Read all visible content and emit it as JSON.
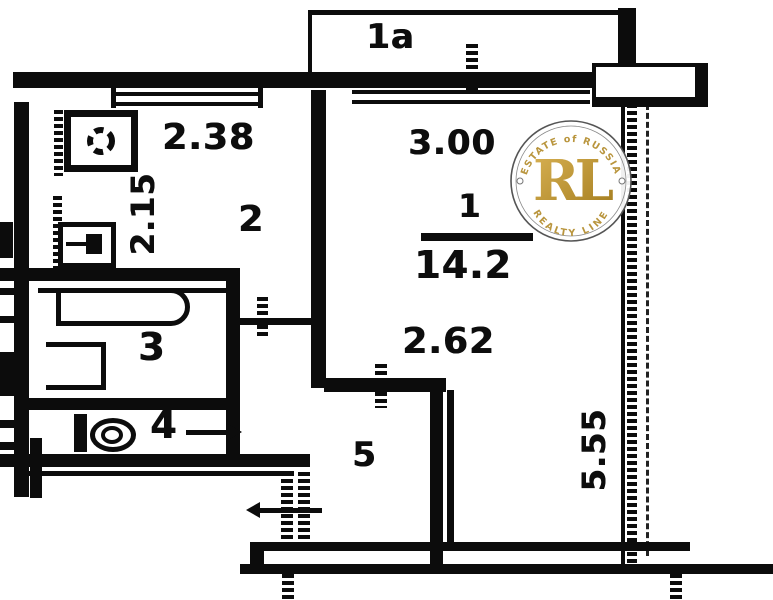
{
  "floorplan": {
    "balcony": {
      "label": "1a"
    },
    "rooms": [
      {
        "number": "1",
        "area": "14.2"
      },
      {
        "number": "2"
      },
      {
        "number": "3"
      },
      {
        "number": "4"
      },
      {
        "number": "5"
      }
    ],
    "dimensions": {
      "kitchen_width": "2.38",
      "kitchen_depth": "2.15",
      "room1_width": "3.00",
      "room1_inner_width": "2.62",
      "room1_depth": "5.55"
    }
  },
  "watermark": {
    "arc_top": "ESTATE of RUSSIA",
    "arc_bottom": "REALTY LINE",
    "monogram": "RL",
    "colors": {
      "gold": "#c59b33",
      "ring": "#555555",
      "arc_text": "#b9953d"
    }
  },
  "colors": {
    "ink": "#0c0c0c",
    "paper": "#ffffff"
  }
}
